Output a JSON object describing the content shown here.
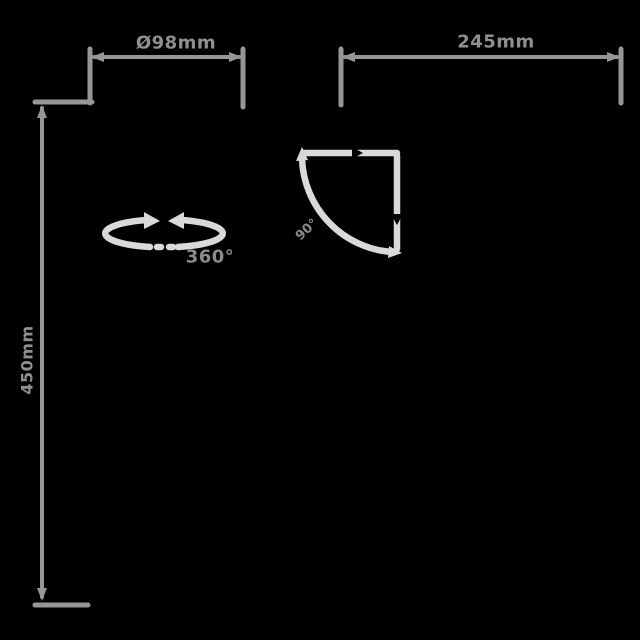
{
  "diagram": {
    "type": "product-dimension-diagram",
    "background_color": "#000000",
    "colors": {
      "dimension_line": "#969696",
      "dimension_text": "#8f8f8f",
      "icon_stroke": "#d9d9d9",
      "icon_text": "#8a8a8a"
    },
    "dimensions": {
      "diameter": {
        "label": "Ø98mm",
        "orientation": "horizontal",
        "position": "top-left"
      },
      "width": {
        "label": "245mm",
        "orientation": "horizontal",
        "position": "top-right"
      },
      "height": {
        "label": "450mm",
        "orientation": "vertical",
        "position": "left"
      }
    },
    "icons": {
      "rotation": {
        "name": "360-rotation-arrows-icon",
        "label": "360°"
      },
      "tilt": {
        "name": "tilt-angle-sector-icon",
        "label": "90°"
      }
    }
  }
}
